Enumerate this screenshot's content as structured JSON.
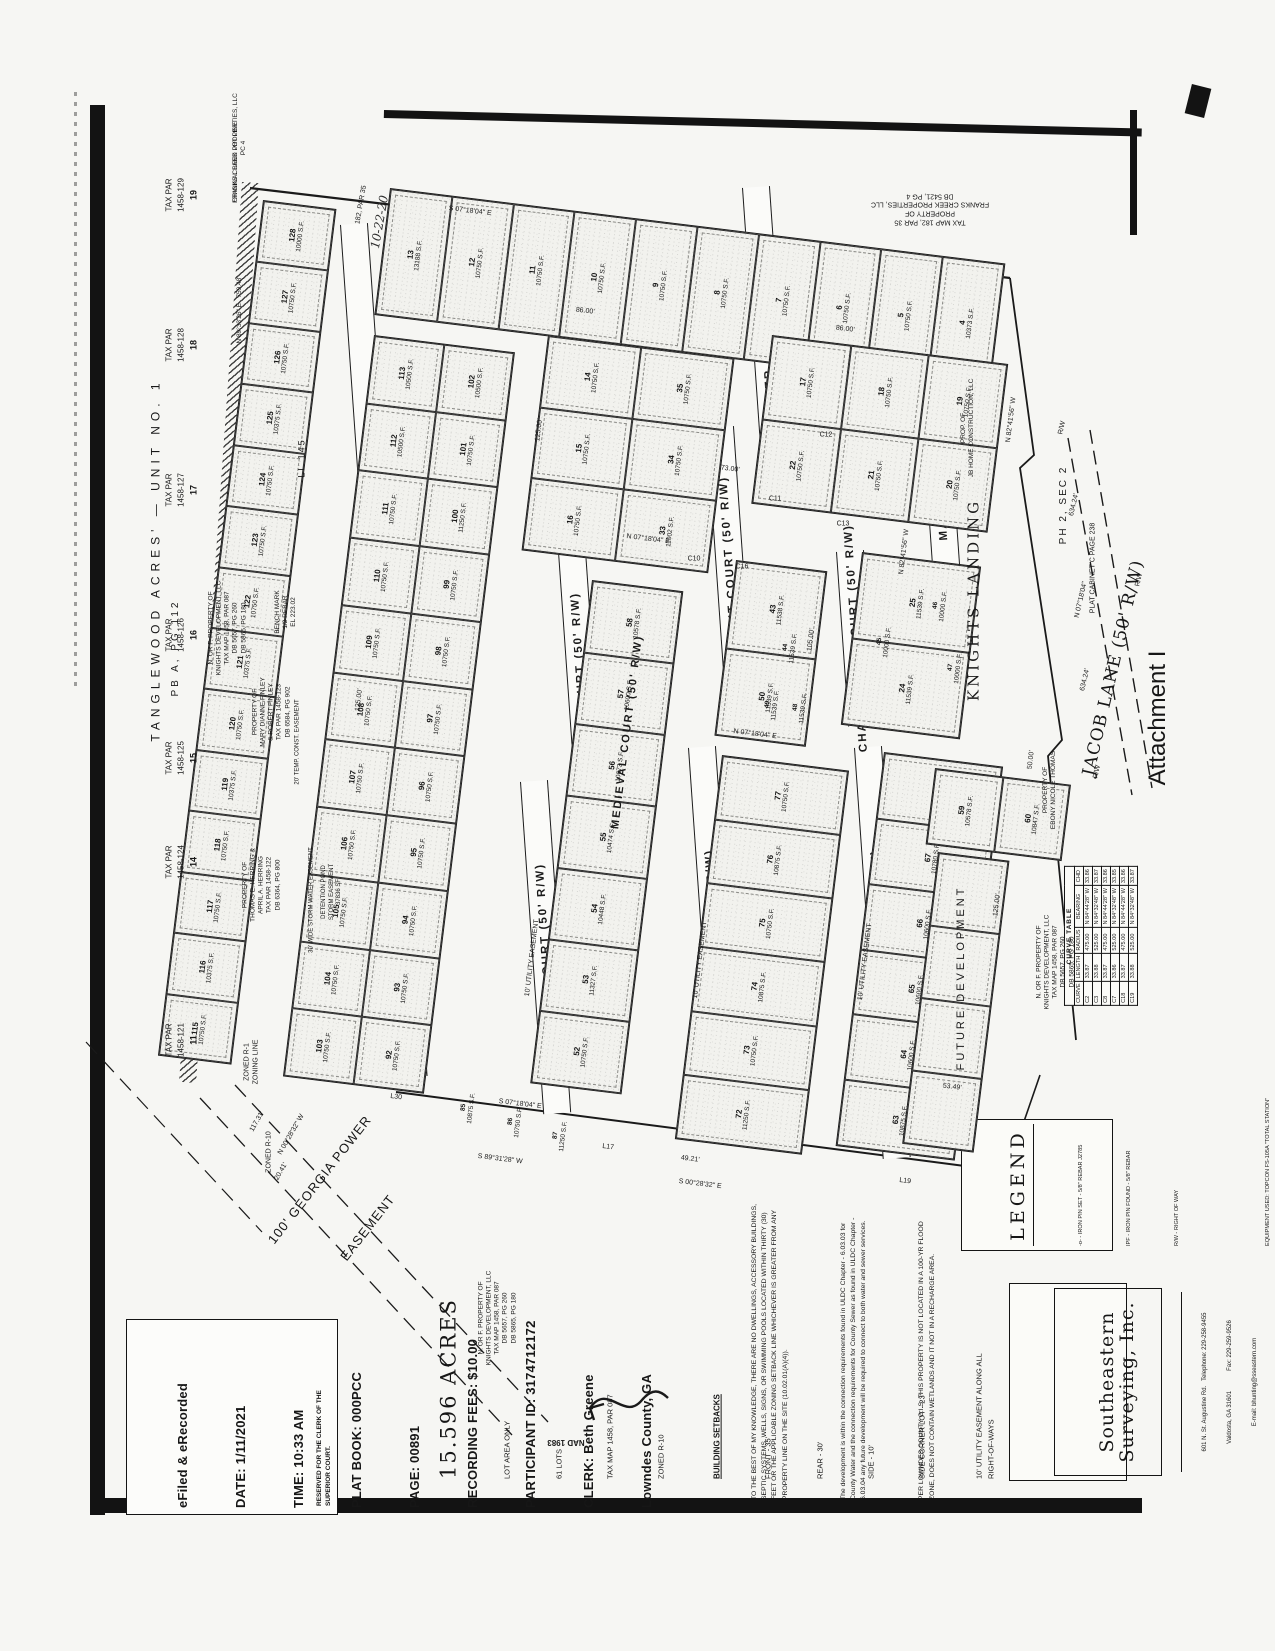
{
  "attachment_label": "Attachment I",
  "stamp": {
    "lines": [
      "eFiled & eRecorded",
      "DATE: 1/11/2021",
      "TIME: 10:33 AM",
      "PLAT BOOK: 000PCC",
      "PAGE: 00891",
      "RECORDING FEES: $10.00",
      "PARTICIPANT ID: 3174712172",
      "CLERK: Beth Greene",
      "Lowndes County, GA"
    ],
    "reserved": "RESERVED FOR THE CLERK OF THE\nSUPERIOR COURT."
  },
  "summary": {
    "acres": "15.596 ACRES",
    "lines": [
      "LOT AREA ONLY",
      "61 LOTS",
      "TAX MAP 1458, PAR 087",
      "ZONED R-10"
    ],
    "setbacks_title": "BUILDING SETBACKS",
    "setbacks": [
      "FRONT - 35'",
      "REAR - 30'",
      "SIDE - 10'",
      "SIDE CORNER LOT - 23'"
    ],
    "utility": "10' UTILITY EASEMENT ALONG ALL\nRIGHT-OF-WAYS"
  },
  "notes": [
    "TO THE BEST OF MY KNOWLEDGE, THERE ARE NO DWELLINGS, ACCESSORY BUILDINGS, SEPTIC SYSTEMS, WELLS, SIGNS, OR SWIMMING POOLS LOCATED WITHIN THIRTY (30) FEET OR THE APPLICABLE ZONING SETBACK LINE WHICHEVER IS GREATER FROM ANY PROPERTY LINE ON THE SITE (10.02.01(A)(4)).",
    "The development is within the connection requirements found in ULDC Chapter - 6.03.03 for County Water and the connection requirements for County Sewer as found in ULDC Chapter - 6.03.04 any future development will be required to connect to both water and sewer services.",
    "PER LOWNDES COUNTY G.I.S. THIS PROPERTY IS NOT LOCATED IN A 100-YR FLOOD ZONE, DOES NOT CONTAIN WETLANDS AND IT NOT IN A RECHARGE AREA."
  ],
  "legend": {
    "title": "LEGEND",
    "items": [
      {
        "sym": "-o-",
        "text": "- IRON PIN SET - 5/8\" REBAR J2785"
      },
      {
        "sym": "IPF",
        "text": "- IRON PIN FOUND - 5/8\" REBAR"
      },
      {
        "sym": "R/W",
        "text": "- RIGHT OF WAY"
      }
    ],
    "notes": [
      "EQUIPMENT USED: TOPCON FS-105A \"TOTAL STATION\"",
      "FIELD CLOSURE: 1/23,475",
      "ANGLE ERROR: 3\"/PT",
      "METHOD OF ADJUSTMENT: NONE",
      "PLAT CLOSURE: 1/INFINITY",
      "BEARINGS SHOWN WERE CALCULATED FROM",
      "FIELD ANGLES TURNED REFERENCED TO",
      "NAD 1983, GEORGIA WEST ZONE."
    ]
  },
  "surveyor": {
    "name1": "Southeastern",
    "name2": "Surveying, Inc.",
    "addr1": "601 N. St. Augustine Rd.   Telephone: 229-258-9455",
    "addr2": "Valdosta, GA 31601            Fax: 229-259-9526",
    "addr3": "E-mail: bhunting@sseastern.com",
    "addr4": "& Certificate of Authorization No. 665"
  },
  "curve_table": {
    "title": "CURVE TABLE",
    "headers": [
      "CURVE",
      "LENGTH",
      "RADIUS",
      "BEARING",
      "CHD"
    ],
    "rows": [
      [
        "C2",
        "33.87",
        "475.00",
        "N 84°44'28\" W",
        "33.86"
      ],
      [
        "C3",
        "33.88",
        "525.00",
        "N 84°32'48\" W",
        "33.87"
      ],
      [
        "C8",
        "33.87",
        "475.00",
        "N 84°44'28\" W",
        "33.86"
      ],
      [
        "C7",
        "33.86",
        "525.00",
        "N 84°32'48\" W",
        "33.85"
      ],
      [
        "C18",
        "33.87",
        "475.00",
        "N 84°44'28\" W",
        "33.86"
      ],
      [
        "C19",
        "33.88",
        "525.00",
        "N 84°32'48\" W",
        "33.87"
      ]
    ]
  },
  "north": {
    "nad": "NAD 1983"
  },
  "layout": {
    "streets": [
      {
        "label": "DUTCHESS COURT (50' R/W)",
        "x": 340,
        "y": 225,
        "len": 855
      },
      {
        "label": "CRUSADER COURT (50' R/W)",
        "x": 742,
        "y": 188,
        "len": 318
      },
      {
        "label": "VALIANT COURT (50' R/W)",
        "x": 706,
        "y": 428,
        "len": 288
      },
      {
        "label": "MEDIEVAL COURT (50' R/W)",
        "x": 558,
        "y": 552,
        "len": 285
      },
      {
        "label": "DUKE COURT (50' R/W)",
        "x": 520,
        "y": 782,
        "len": 333
      },
      {
        "label": "BISHOP COURT (50' R/W)",
        "x": 688,
        "y": 748,
        "len": 388
      },
      {
        "label": "COUNTESS COURT (50' R/W)",
        "x": 854,
        "y": 748,
        "len": 412
      },
      {
        "label": "CHANCELLOR COURT (50' R/W)",
        "x": 836,
        "y": 552,
        "len": 175
      },
      {
        "label": "MAIDEN WAY",
        "x": 922,
        "y": 422,
        "len": 145
      }
    ],
    "blocks": [
      {
        "x": 390,
        "y": 188,
        "w": 618,
        "h": 126,
        "rows": 1,
        "cols": 10,
        "lots": [
          "13|13188 S.F.",
          "12|10750 S.F.",
          "11|10750 S.F.",
          "10|10750 S.F.",
          "9|10750 S.F.",
          "8|10750 S.F.",
          "7|10750 S.F.",
          "6|10750 S.F.",
          "5|10750 S.F.",
          "4|10373 S.F."
        ]
      },
      {
        "x": 263,
        "y": 200,
        "w": 72,
        "h": 860,
        "rows": 14,
        "cols": 1,
        "lots": [
          "128|10000 S.F.",
          "127|10750 S.F.",
          "126|10750 S.F.",
          "125|10375 S.F.",
          "124|10750 S.F.",
          "123|10750 S.F.",
          "122|10750 S.F.",
          "121|10375 S.F.",
          "120|10750 S.F.",
          "119|10375 S.F.",
          "118|10750 S.F.",
          "117|10750 S.F.",
          "116|10375 S.F.",
          "115|10750 S.F."
        ]
      },
      {
        "x": 374,
        "y": 335,
        "w": 140,
        "h": 745,
        "rows": 11,
        "cols": 2,
        "lots": [
          "113|10500 S.F.",
          "102|10500 S.F.",
          "112|10500 S.F.",
          "101|10750 S.F.",
          "111|10750 S.F.",
          "100|11250 S.F.",
          "110|10750 S.F.",
          "99|10750 S.F.",
          "109|10750 S.F.",
          "98|10750 S.F.",
          "108|10750 S.F.",
          "97|10750 S.F.",
          "107|10750 S.F.",
          "96|10750 S.F.",
          "106|10750 S.F.",
          "95|10750 S.F.",
          "105|10750 S.F.",
          "94|10750 S.F.",
          "104|10750 S.F.",
          "93|10750 S.F.",
          "103|10750 S.F.",
          "92|10750 S.F."
        ]
      },
      {
        "x": 548,
        "y": 335,
        "w": 186,
        "h": 215,
        "rows": 3,
        "cols": 2,
        "lots": [
          "14|10750 S.F.",
          "35|10750 S.F.",
          "15|10750 S.F.",
          "34|10750 S.F.",
          "16|10750 S.F.",
          "33|11002 S.F."
        ]
      },
      {
        "x": 772,
        "y": 335,
        "w": 236,
        "h": 168,
        "rows": 2,
        "cols": 3,
        "lots": [
          "17|10750 S.F.",
          "18|10750 S.F.",
          "19|10750 S.F.",
          "22|10750 S.F.",
          "21|10750 S.F.",
          "20|10750 S.F."
        ]
      },
      {
        "x": 736,
        "y": 560,
        "w": 90,
        "h": 175,
        "rows": 2,
        "cols": 1,
        "lots": [
          "43|11538 S.F.",
          "50|11539 S.F."
        ]
      },
      {
        "x": 862,
        "y": 552,
        "w": 118,
        "h": 172,
        "rows": 2,
        "cols": 1,
        "lots": [
          "25|11539 S.F.",
          "24|11539 S.F."
        ]
      },
      {
        "x": 592,
        "y": 580,
        "w": 90,
        "h": 505,
        "rows": 7,
        "cols": 1,
        "lots": [
          "58|10578 S.F.",
          "57|10600 S.F.",
          "56|10673 S.F.",
          "55|10474 S.F.",
          "54|10448 S.F.",
          "53|11327 S.F.",
          "52|10750 S.F."
        ]
      },
      {
        "x": 722,
        "y": 755,
        "w": 126,
        "h": 385,
        "rows": 6,
        "cols": 1,
        "lots": [
          "77|10750 S.F.",
          "76|10875 S.F.",
          "75|10750 S.F.",
          "74|10875 S.F.",
          "73|10750 S.F.",
          "72|11250 S.F."
        ]
      },
      {
        "x": 884,
        "y": 752,
        "w": 118,
        "h": 395,
        "rows": 6,
        "cols": 1,
        "lots": [
          "68|10578 S.F.",
          "67|10780 S.F.",
          "66|10600 S.F.",
          "65|10600 S.F.",
          "64|10600 S.F.",
          "63|10875 S.F."
        ]
      },
      {
        "x": 935,
        "y": 768,
        "w": 135,
        "h": 75,
        "rows": 1,
        "cols": 2,
        "lots": [
          "59|10578 S.F.",
          "60|10847 S.F."
        ]
      },
      {
        "x": 938,
        "y": 852,
        "w": 70,
        "h": 292,
        "rows": 4,
        "cols": 1,
        "lots": [
          "|",
          "|",
          "|",
          "|"
        ]
      }
    ],
    "extra_lots": [
      {
        "n": "44",
        "a": "11539 S.F.",
        "x": 790,
        "y": 648
      },
      {
        "n": "45",
        "a": "10000 S.F.",
        "x": 884,
        "y": 642
      },
      {
        "n": "46",
        "a": "10000 S.F.",
        "x": 940,
        "y": 606
      },
      {
        "n": "47",
        "a": "10000 S.F.",
        "x": 955,
        "y": 668
      },
      {
        "n": "48",
        "a": "11539 S.F.",
        "x": 800,
        "y": 708
      },
      {
        "n": "49",
        "a": "11539 S.F.",
        "x": 772,
        "y": 705
      },
      {
        "n": "85",
        "a": "10875 S.F.",
        "x": 468,
        "y": 1108
      },
      {
        "n": "86",
        "a": "10750 S.F.",
        "x": 515,
        "y": 1122
      },
      {
        "n": "87",
        "a": "11250 S.F.",
        "x": 560,
        "y": 1136
      }
    ],
    "parcels": [
      {
        "par": "1458-129",
        "lot": "19",
        "x": 182,
        "y": 195
      },
      {
        "par": "1458-128",
        "lot": "18",
        "x": 182,
        "y": 345
      },
      {
        "par": "1458-127",
        "lot": "17",
        "x": 182,
        "y": 490
      },
      {
        "par": "1458-126",
        "lot": "16",
        "x": 182,
        "y": 635
      },
      {
        "par": "1458-125",
        "lot": "15",
        "x": 182,
        "y": 758
      },
      {
        "par": "1458-124",
        "lot": "14",
        "x": 182,
        "y": 862
      },
      {
        "par": "1458-121",
        "lot": "11",
        "x": 182,
        "y": 1040
      }
    ],
    "owners": [
      {
        "x": 156,
        "y": 560,
        "r": -90,
        "size": 12,
        "ls": 5,
        "lines": [
          "TANGLEWOOD ACRES' — UNIT NO. 1"
        ]
      },
      {
        "x": 176,
        "y": 648,
        "r": -90,
        "size": 10,
        "ls": 3,
        "lines": [
          "PB A, PG 112"
        ]
      },
      {
        "x": 236,
        "y": 162,
        "r": -90,
        "size": 6.5,
        "lines": [
          "ORIGINAL LAND LOT LINE"
        ]
      },
      {
        "x": 240,
        "y": 310,
        "r": -90,
        "size": 6.5,
        "lines": [
          "N 89°33'26\" E   759.48'"
        ]
      },
      {
        "x": 240,
        "y": 148,
        "r": -90,
        "size": 6.5,
        "lines": [
          "FRANKS CREEK PROPERTIES, LLC",
          "PC 4"
        ]
      },
      {
        "x": 228,
        "y": 628,
        "r": -90,
        "size": 6.5,
        "lines": [
          "N. OR F. PROPERTY OF",
          "KNIGHTS DEVELOPMENT, LLC",
          "TAX MAP 1458, PAR 087",
          "DB 5657, PG 260",
          "DB 5865, PG 180"
        ]
      },
      {
        "x": 272,
        "y": 712,
        "r": -90,
        "size": 6.5,
        "lines": [
          "PROPERTY OF",
          "MARY DIANNE FINLEY",
          "& ROBERT FINLEY",
          "TAX PAR 1458-123",
          "DB 6584, PG 902"
        ]
      },
      {
        "x": 298,
        "y": 742,
        "r": -90,
        "size": 6,
        "lines": [
          "20' TEMP. CONST. EASEMENT"
        ]
      },
      {
        "x": 262,
        "y": 885,
        "r": -90,
        "size": 6.5,
        "lines": [
          "PROPERTY OF",
          "THOMAS E. HERRING &",
          "APRIL A. HERRING",
          "TAX PAR 1458-122",
          "DB 6364, PG 800"
        ]
      },
      {
        "x": 312,
        "y": 900,
        "r": -90,
        "size": 6,
        "lines": [
          "30' WIDE STORM WATER EASEMENT"
        ]
      },
      {
        "x": 332,
        "y": 892,
        "r": -90,
        "size": 6,
        "lines": [
          "DETENTION POND",
          "STORM EASEMENT",
          "37836 SF"
        ]
      },
      {
        "x": 286,
        "y": 612,
        "r": -90,
        "size": 6.5,
        "lines": [
          "BENCH MARK",
          "1/2 REBAR",
          "EL 223.02"
        ]
      },
      {
        "x": 302,
        "y": 458,
        "r": -90,
        "size": 9,
        "ls": 2,
        "lines": [
          "LL 145"
        ]
      },
      {
        "x": 252,
        "y": 1062,
        "r": -90,
        "size": 7,
        "lines": [
          "ZONED R-1",
          "ZONING LINE"
        ]
      },
      {
        "x": 270,
        "y": 1152,
        "r": -90,
        "size": 7,
        "lines": [
          "ZONED R-10"
        ]
      },
      {
        "x": 498,
        "y": 1318,
        "r": -90,
        "size": 6.5,
        "lines": [
          "N. OR F. PROPERTY OF",
          "KNIGHTS DEVELOPMENT, LLC",
          "TAX MAP 1458, PAR 087",
          "DB 5657, PG 260",
          "DB 5865, PG 180"
        ]
      },
      {
        "x": 1056,
        "y": 962,
        "r": -90,
        "size": 6.5,
        "lines": [
          "N. OR F. PROPERTY OF",
          "KNIGHTS DEVELOPMENT, LLC",
          "TAX MAP 1458, PAR 087",
          "DB 5657, PG 260",
          "DB 5865, PG 180"
        ]
      },
      {
        "x": 1050,
        "y": 790,
        "r": -90,
        "size": 6.5,
        "lines": [
          "PROPERTY OF",
          "EBONY NICOLE THOMAS"
        ]
      },
      {
        "x": 930,
        "y": 208,
        "r": 180,
        "size": 7,
        "lines": [
          "TAX MAP 182, PAR 35",
          "PROPERTY OF",
          "FRANKS CREEK PROPERTIES, LLC",
          "DB 5421, PG 4"
        ]
      },
      {
        "x": 968,
        "y": 428,
        "r": -90,
        "size": 6.5,
        "lines": [
          "PROP. OF",
          "JB HOME CONSTRUCTION, LLC"
        ]
      },
      {
        "x": 974,
        "y": 600,
        "r": -90,
        "size": 15,
        "ls": 3,
        "serif": true,
        "lines": [
          "KNIGHTS LANDING"
        ]
      },
      {
        "x": 1064,
        "y": 505,
        "r": -90,
        "size": 10,
        "ls": 2,
        "lines": [
          "PH 2, SEC 2"
        ]
      },
      {
        "x": 1094,
        "y": 568,
        "r": -90,
        "size": 7,
        "lines": [
          "PLAT CABINET C PAGE 238"
        ]
      },
      {
        "x": 962,
        "y": 978,
        "r": -90,
        "size": 11,
        "ls": 3,
        "lines": [
          "FUTURE DEVELOPMENT"
        ]
      }
    ],
    "labels": [
      {
        "t": "S 07°18'04\" E",
        "x": 470,
        "y": 212,
        "r": 7
      },
      {
        "t": "86.00'",
        "x": 585,
        "y": 312,
        "r": 7
      },
      {
        "t": "86.00'",
        "x": 845,
        "y": 330,
        "r": 7
      },
      {
        "t": "N 07°18'04\" E",
        "x": 648,
        "y": 540,
        "r": 7
      },
      {
        "t": "N 07°18'04\" E",
        "x": 755,
        "y": 735,
        "r": 7
      },
      {
        "t": "S 07°18'04\" E",
        "x": 520,
        "y": 1105,
        "r": 7
      },
      {
        "t": "N 82°41'56\" W",
        "x": 905,
        "y": 552,
        "r": -83
      },
      {
        "t": "N 82°41'56\" W",
        "x": 1012,
        "y": 420,
        "r": -83
      },
      {
        "t": "125.00'",
        "x": 360,
        "y": 700,
        "r": -83
      },
      {
        "t": "125.00'",
        "x": 540,
        "y": 430,
        "r": -83
      },
      {
        "t": "125.00'",
        "x": 998,
        "y": 905,
        "r": -83
      },
      {
        "t": "105.00'",
        "x": 812,
        "y": 640,
        "r": -83
      },
      {
        "t": "73.00'",
        "x": 730,
        "y": 470,
        "r": 7
      },
      {
        "t": "S 89°31'28\" W",
        "x": 500,
        "y": 1160,
        "r": 7
      },
      {
        "t": "S 00°28'32\" E",
        "x": 700,
        "y": 1185,
        "r": 7
      },
      {
        "t": "N 00°28'32\" W",
        "x": 292,
        "y": 1135,
        "r": -60
      },
      {
        "t": "117.31'",
        "x": 258,
        "y": 1122,
        "r": -60
      },
      {
        "t": "20.41'",
        "x": 282,
        "y": 1172,
        "r": -60
      },
      {
        "t": "N 07°18'04\"",
        "x": 1082,
        "y": 600,
        "r": -77
      },
      {
        "t": "634.24'",
        "x": 1086,
        "y": 680,
        "r": -77
      },
      {
        "t": "634.24'",
        "x": 1075,
        "y": 505,
        "r": -77
      },
      {
        "t": "R/W",
        "x": 1140,
        "y": 580,
        "r": -77
      },
      {
        "t": "R/W",
        "x": 1098,
        "y": 772,
        "r": -77
      },
      {
        "t": "R/W",
        "x": 1063,
        "y": 428,
        "r": -77
      },
      {
        "t": "L17",
        "x": 608,
        "y": 1148,
        "r": 7
      },
      {
        "t": "L19",
        "x": 905,
        "y": 1182,
        "r": 7
      },
      {
        "t": "L30",
        "x": 396,
        "y": 1098,
        "r": 7
      },
      {
        "t": "C10",
        "x": 694,
        "y": 560,
        "r": 0
      },
      {
        "t": "C11",
        "x": 775,
        "y": 500,
        "r": 0
      },
      {
        "t": "C12",
        "x": 826,
        "y": 436,
        "r": 0
      },
      {
        "t": "C13",
        "x": 843,
        "y": 525,
        "r": 0
      },
      {
        "t": "C16",
        "x": 742,
        "y": 568,
        "r": 0
      },
      {
        "t": "53.49'",
        "x": 952,
        "y": 1088,
        "r": 7
      },
      {
        "t": "50.00'",
        "x": 1032,
        "y": 760,
        "r": -83
      },
      {
        "t": "49.21'",
        "x": 690,
        "y": 1160,
        "r": 7
      },
      {
        "t": "MEDIEVAL COURT (50' R/W)",
        "x": 628,
        "y": 732,
        "r": -83,
        "big": true
      },
      {
        "t": "10' UTILITY EASEMENT",
        "x": 533,
        "y": 958,
        "r": -83
      },
      {
        "t": "10' UTILITY EASEMENT",
        "x": 701,
        "y": 960,
        "r": -83
      },
      {
        "t": "10' UTILITY EASEMENT",
        "x": 866,
        "y": 962,
        "r": -83
      },
      {
        "t": "182, PAR 35",
        "x": 362,
        "y": 205,
        "r": -80
      }
    ],
    "georgia_power": {
      "line1": "100' GEORGIA POWER",
      "line2": "EASEMENT"
    },
    "jacob_lane": "JACOB LANE (50' R/W)",
    "handwriting": "10-22-20"
  }
}
